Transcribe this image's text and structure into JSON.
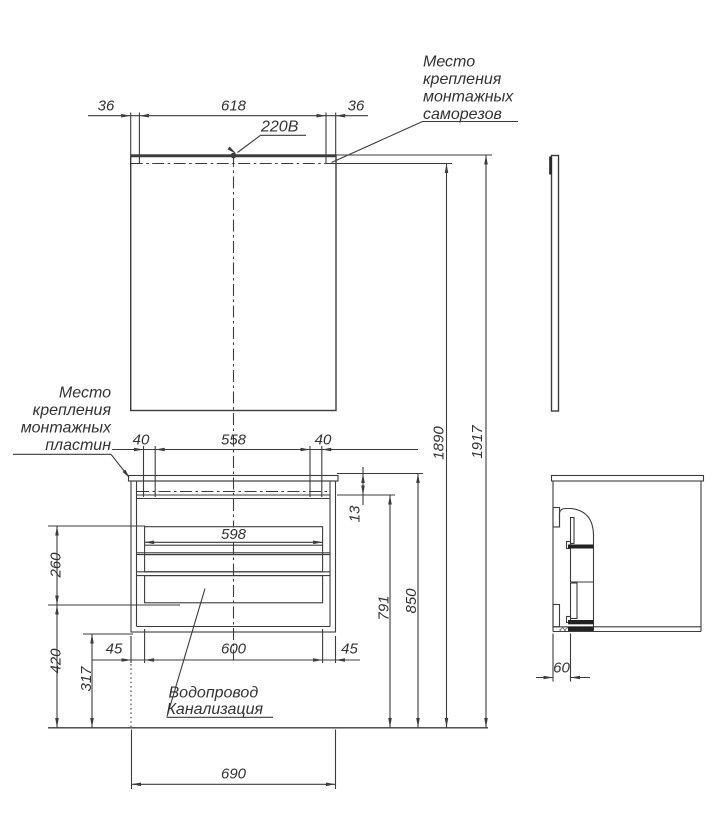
{
  "notes": {
    "screws": {
      "lines": [
        "Место",
        "крепления",
        "монтажных",
        "саморезов"
      ]
    },
    "plates": {
      "lines": [
        "Место",
        "крепления",
        "монтажных",
        "пластин"
      ]
    },
    "plumbing": {
      "lines": [
        "Водопровод",
        "Канализация"
      ]
    },
    "power": "220В"
  },
  "dims": {
    "mirror_top": [
      "36",
      "618",
      "36"
    ],
    "plates": [
      "40",
      "558",
      "40"
    ],
    "drawer_front_width": "598",
    "cabinet_bottom": [
      "45",
      "600",
      "45"
    ],
    "overall_bottom": "690",
    "side_depth": "60",
    "countertop_gap": "13",
    "drawer_zone_height": "260",
    "drawers_to_floor": "420",
    "cabinet_bottom_to_floor": "317",
    "rail_to_floor": "791",
    "countertop_to_floor": "850",
    "mount_line_to_floor": "1890",
    "mirror_top_to_floor": "1917"
  }
}
